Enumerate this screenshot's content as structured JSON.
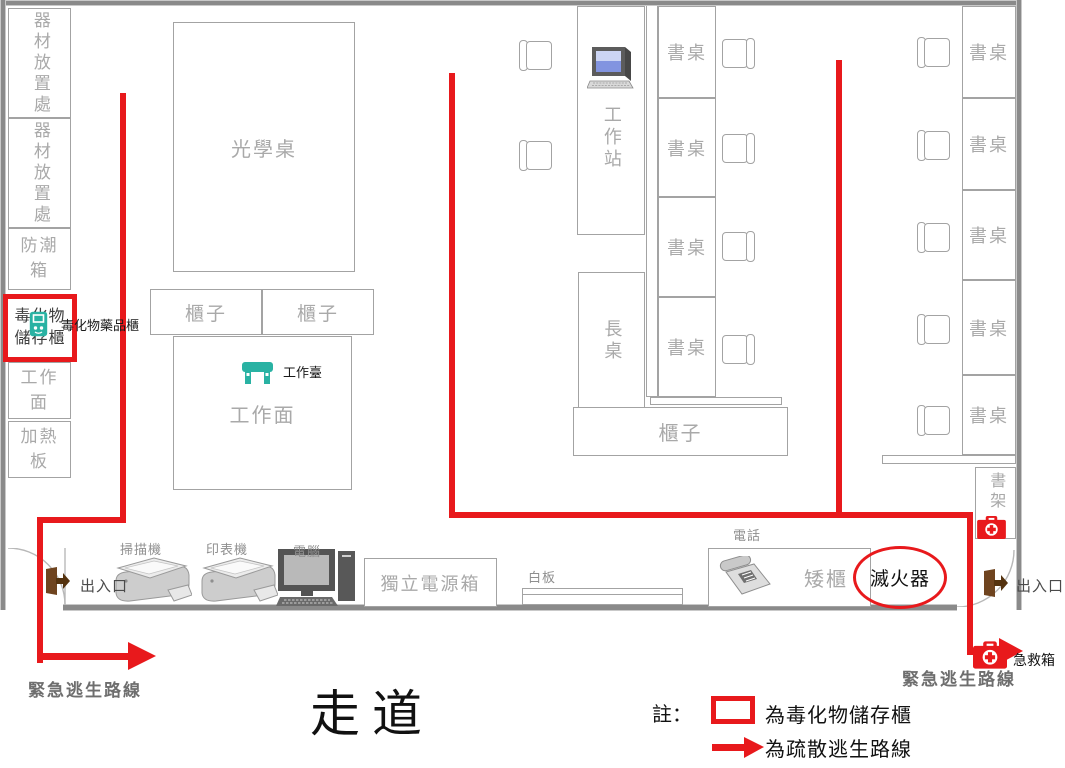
{
  "plan": {
    "left_column": {
      "equipment_storage": "器材放置處",
      "moisture_box": "防潮箱",
      "toxic_cabinet_line1": "毒化物",
      "toxic_cabinet_line2": "儲存櫃",
      "toxic_cabinet_label": "毒化物藥品櫃",
      "work_surface": "工作面",
      "heating_plate": "加熱板"
    },
    "center": {
      "optical_table": "光學桌",
      "cabinet": "櫃子",
      "work_surface": "工作面",
      "workbench": "工作臺"
    },
    "middle": {
      "workstation": "工作站",
      "long_table": "長桌",
      "desk": "書桌",
      "cabinet": "櫃子"
    },
    "right": {
      "desk": "書桌",
      "bookshelf": "書架"
    },
    "bottom": {
      "exit": "出入口",
      "scanner": "掃描機",
      "printer": "印表機",
      "computer": "電腦",
      "power_box": "獨立電源箱",
      "whiteboard": "白板",
      "telephone": "電話",
      "low_cabinet": "矮櫃",
      "fire_extinguisher": "滅火器",
      "first_aid_kit": "急救箱"
    },
    "escape_route_label": "緊急逃生路線",
    "corridor": "走道",
    "legend": {
      "note": "註：",
      "toxic_cabinet": "為毒化物儲存櫃",
      "escape_route": "為疏散逃生路線"
    },
    "colors": {
      "route_red": "#e8191c",
      "teal": "#29b2a3",
      "door_brown": "#6f441f",
      "wall_gray": "#8a8a8a",
      "furniture_label_gray": "#a9a9a9"
    }
  }
}
